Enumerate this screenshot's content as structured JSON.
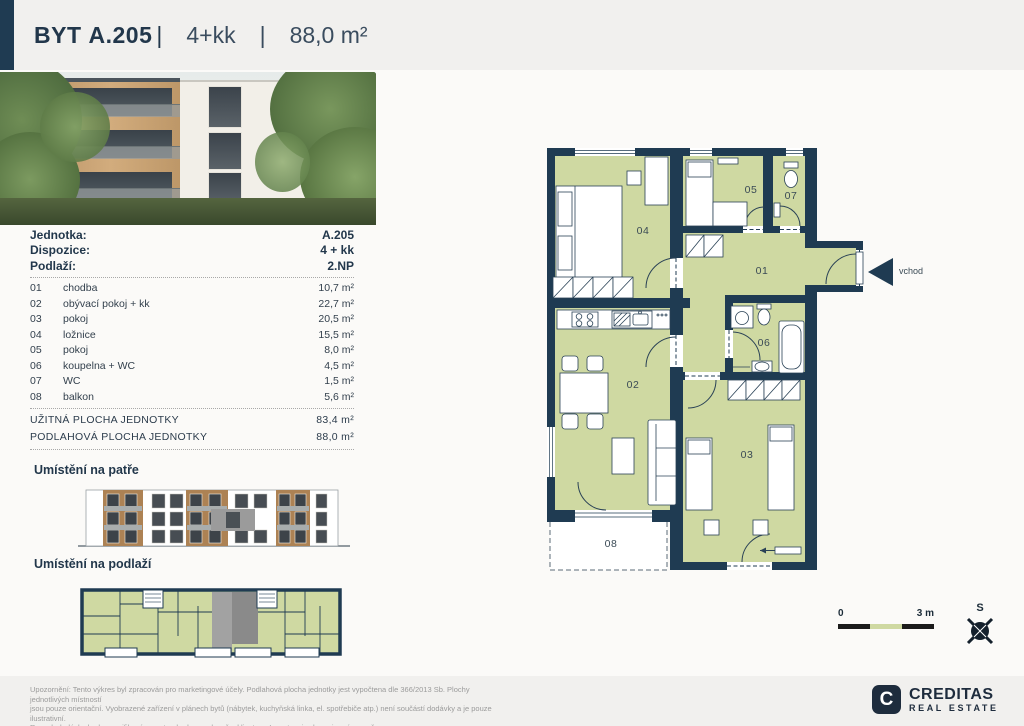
{
  "header": {
    "byt": "BYT",
    "unit": "A.205",
    "sep": "|",
    "layout": "4+kk",
    "area": "88,0 m²"
  },
  "brand": {
    "name": "NOVÁ VALCHA"
  },
  "info": {
    "rows": [
      {
        "label": "Jednotka:",
        "value": "A.205"
      },
      {
        "label": "Dispozice:",
        "value": "4 + kk"
      },
      {
        "label": "Podlaží:",
        "value": "2.NP"
      }
    ]
  },
  "rooms": [
    {
      "num": "01",
      "name": "chodba",
      "area": "10,7 m²"
    },
    {
      "num": "02",
      "name": "obývací pokoj + kk",
      "area": "22,7 m²"
    },
    {
      "num": "03",
      "name": "pokoj",
      "area": "20,5 m²"
    },
    {
      "num": "04",
      "name": "ložnice",
      "area": "15,5 m²"
    },
    {
      "num": "05",
      "name": "pokoj",
      "area": "8,0 m²"
    },
    {
      "num": "06",
      "name": "koupelna + WC",
      "area": "4,5 m²"
    },
    {
      "num": "07",
      "name": "WC",
      "area": "1,5 m²"
    },
    {
      "num": "08",
      "name": "balkon",
      "area": "5,6 m²"
    }
  ],
  "totals": [
    {
      "label": "UŽITNÁ PLOCHA JEDNOTKY",
      "value": "83,4 m²"
    },
    {
      "label": "PODLAHOVÁ PLOCHA JEDNOTKY",
      "value": "88,0 m²"
    }
  ],
  "sections": {
    "floor": "Umístění na patře",
    "plan": "Umístění na podlaží"
  },
  "floorplan": {
    "entrance": "vchod"
  },
  "scalebar": {
    "zero": "0",
    "three": "3 m"
  },
  "compass": {
    "north": "S"
  },
  "footer": {
    "line1": "Upozornění: Tento výkres byl zpracován pro marketingové účely. Podlahová plocha jednotky jest vypočtena dle 366/2013 Sb. Plochy jednotlivých místností",
    "line2": "jsou pouze orientační. Vyobrazené zařízení v plánech bytů (nábytek, kuchyňská linka, el. spotřebiče atp.) není součástí dodávky a je pouze ilustrativní.",
    "line3": "Rozsah dodávky bude specifikován ve standardu a smlouvě s klientem. Investor si vyhrazuje právo změny."
  },
  "creditas": {
    "initial": "C",
    "name": "CREDITAS",
    "sub": "REAL ESTATE"
  }
}
